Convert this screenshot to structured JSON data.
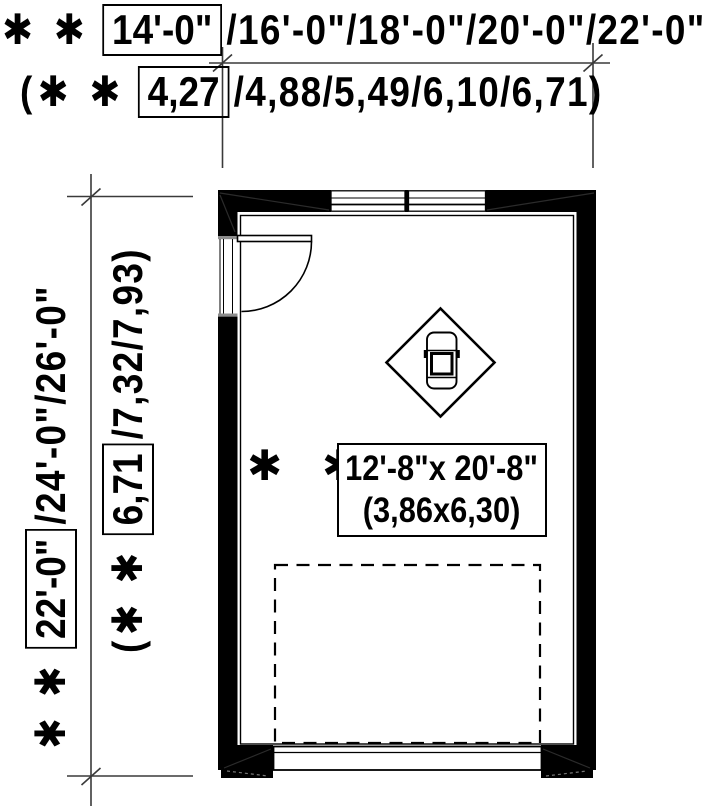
{
  "page": {
    "background": "#ffffff",
    "ink_color": "#000000",
    "dim_line_color": "#3a3a3a",
    "gray_accent": "#8c8c8c"
  },
  "top_dimension": {
    "imperial": {
      "prefix": "✱ ✱",
      "boxed": "14'-0\"",
      "rest": "/16'-0\"/18'-0\"/20'-0\"/22'-0\""
    },
    "metric": {
      "prefix": "(✱ ✱",
      "boxed": "4,27",
      "rest": "/4,88/5,49/6,10/6,71)"
    }
  },
  "left_dimension": {
    "imperial": {
      "prefix": "✱ ✱",
      "boxed": "22'-0\"",
      "rest": "/24'-0\"/26'-0\""
    },
    "metric": {
      "prefix": "(✱ ✱",
      "boxed": "6,71",
      "rest": "/7,32/7,93)"
    }
  },
  "room_label": {
    "prefix": "✱ ✱",
    "imperial": "12'-8\"x 20'-8\"",
    "metric": "(3,86x6,30)"
  },
  "icons": {
    "car": "car-top-view-icon",
    "door": "door-swing-icon",
    "windows": "window-icon",
    "garage_door": "garage-door-icon",
    "diamond": "car-diamond-marker"
  }
}
